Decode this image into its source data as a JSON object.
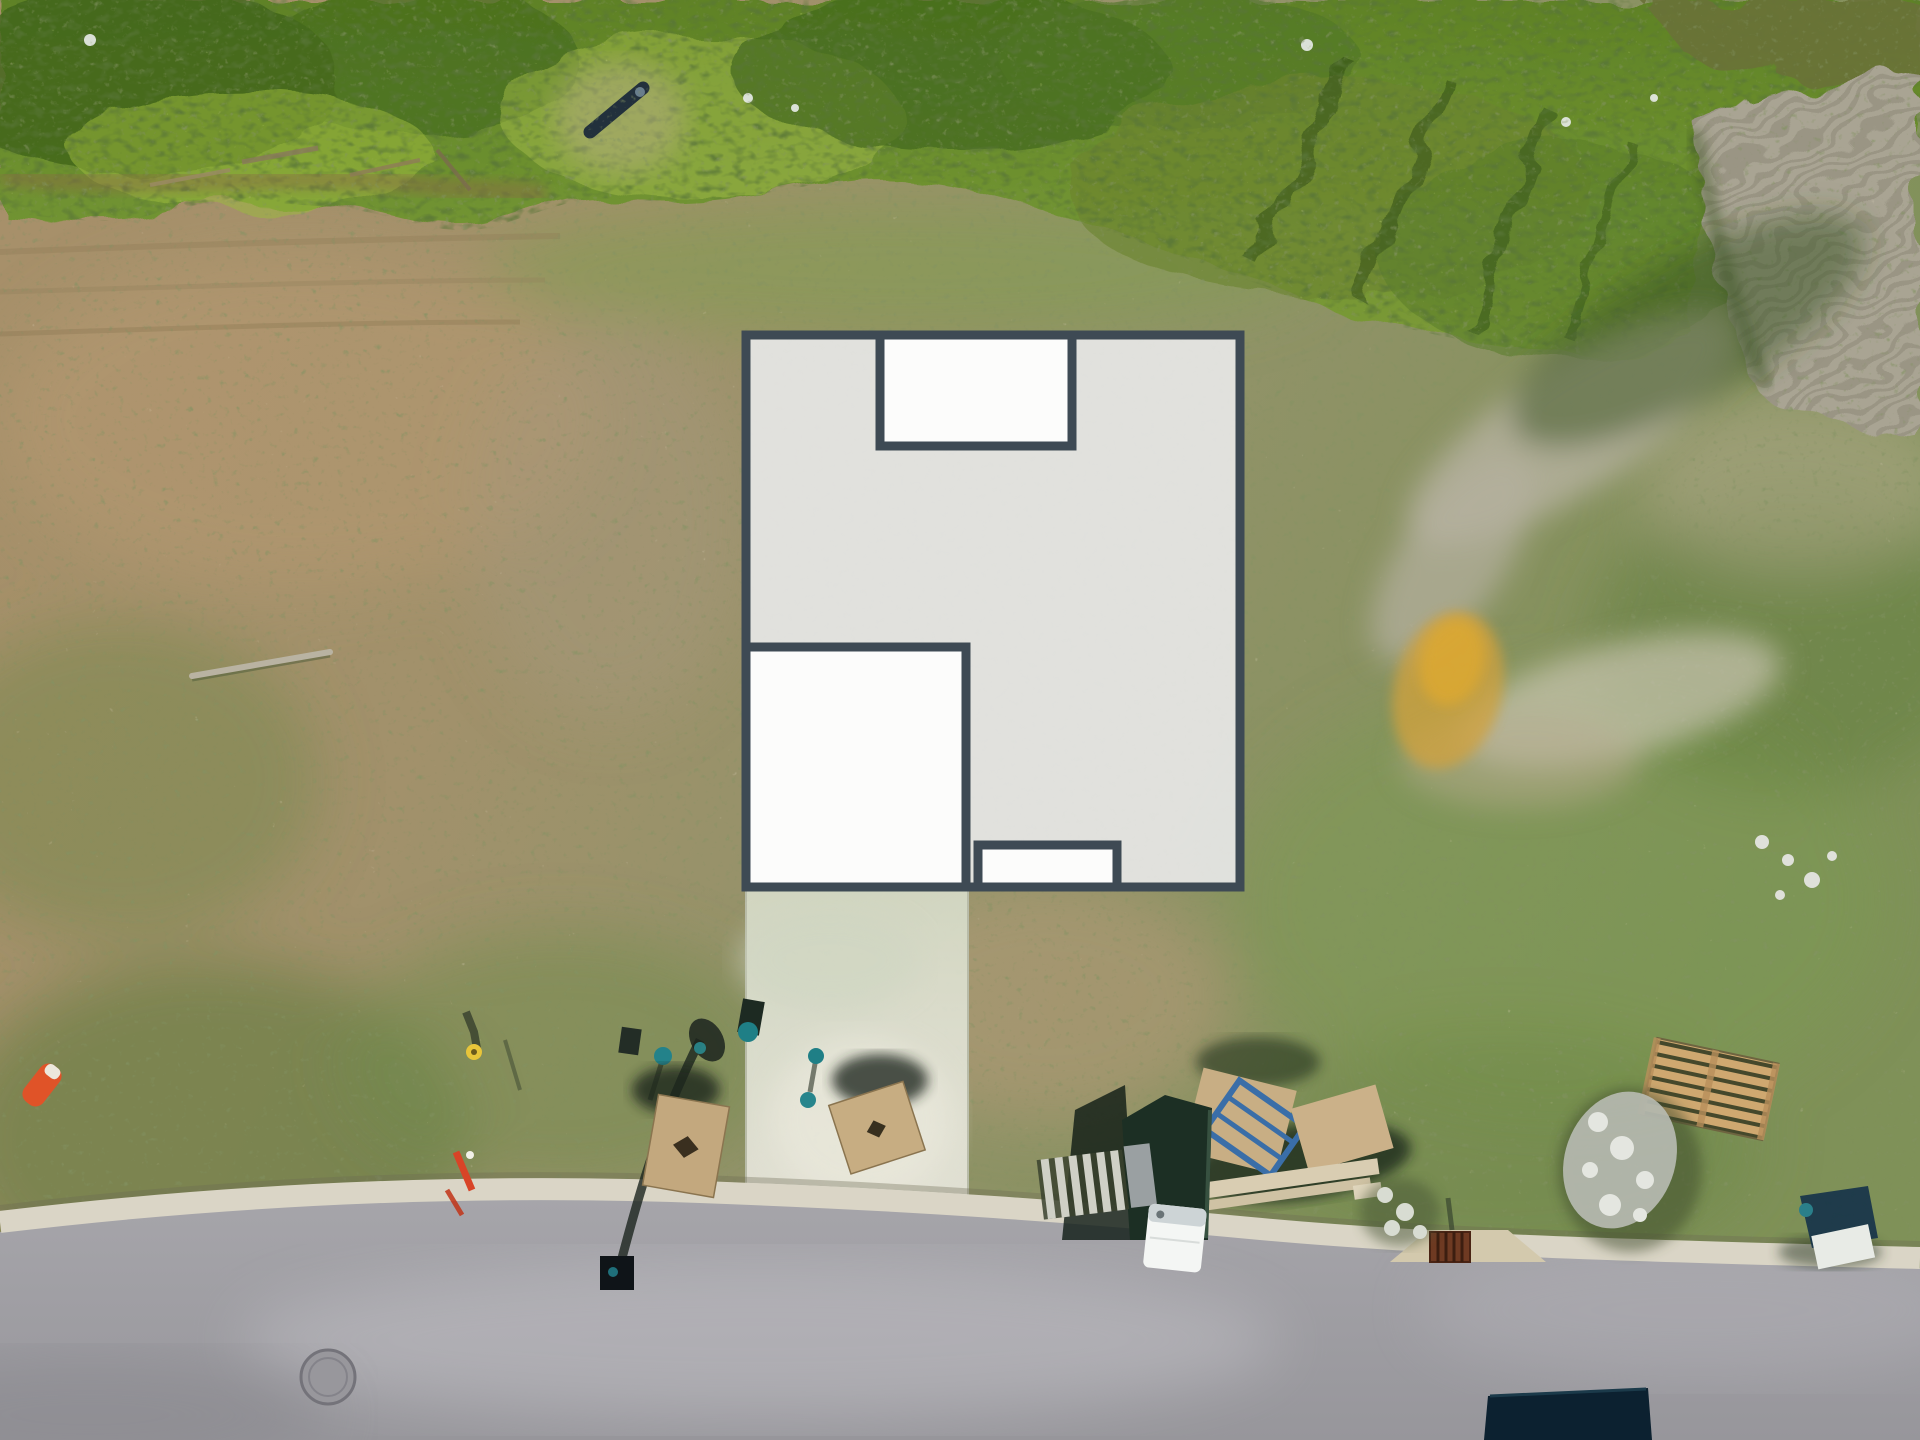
{
  "scene": {
    "title": "Aerial lot view with building footprint overlay",
    "description": "Top-down drone photograph of a cleared residential lot between a green tree line and a curbed street, with a gray proposed building footprint diagram overlaid on the ground and an existing light concrete driveway pad running from the footprint down to the road."
  },
  "palette": {
    "footprint_fill": "#e4e4e2",
    "footprint_room_fill": "#fdfdfc",
    "footprint_border": "#3e4a54",
    "driveway_concrete": "#dfe1d3",
    "curb_concrete": "#dad5c6",
    "road_asphalt": "#a2a1a6",
    "vegetation_green": "#6f9230",
    "field_dirt_tan": "#a8906a",
    "safety_cone_orange": "#e05328",
    "survey_cap_teal": "#23828a",
    "plywood_tan": "#c6ab80",
    "drain_rust": "#6e3a22",
    "dark_object_navy": "#0c2130"
  },
  "footprint": {
    "label": "Proposed building footprint overlay",
    "rooms": [
      {
        "name": "main-footprint",
        "label": "Main footprint area"
      },
      {
        "name": "top-room",
        "label": "Upper inset room / porch"
      },
      {
        "name": "left-room",
        "label": "Lower-left room / garage"
      },
      {
        "name": "bottom-stoop",
        "label": "Small bottom stoop"
      }
    ]
  },
  "objects": [
    {
      "name": "tree-line",
      "label": "Dense green vegetation band along top of lot"
    },
    {
      "name": "eroded-slope",
      "label": "Gray striated eroded slope at top right"
    },
    {
      "name": "dirt-field",
      "label": "Cleared dirt and patchy grass lot"
    },
    {
      "name": "driveway-pad",
      "label": "Light concrete driveway pad"
    },
    {
      "name": "street",
      "label": "Asphalt street with concrete curb"
    },
    {
      "name": "manhole-cover",
      "label": "Round manhole cover in street"
    },
    {
      "name": "storm-drain",
      "label": "Rust-colored storm drain grate at curb"
    },
    {
      "name": "safety-cone",
      "label": "Tipped orange safety cone"
    },
    {
      "name": "streetlight-shadow",
      "label": "Streetlight pole shadow and base box"
    },
    {
      "name": "survey-markers",
      "label": "Survey stakes with teal and yellow caps"
    },
    {
      "name": "plywood-boards",
      "label": "Plywood boards with cut holes"
    },
    {
      "name": "materials-pile",
      "label": "Plywood sheets, blue frame and lumber pile"
    },
    {
      "name": "portable-toilet",
      "label": "White portable toilet beside dark dumpster"
    },
    {
      "name": "wooden-pallet",
      "label": "Wooden pallet on grass"
    },
    {
      "name": "rubble-piles",
      "label": "White rock and debris piles"
    },
    {
      "name": "tarp-debris",
      "label": "Dark tarp and white sheet debris at curb"
    },
    {
      "name": "dark-object",
      "label": "Dark rectangular object at bottom edge of road"
    },
    {
      "name": "log",
      "label": "Thin fallen log on dirt"
    },
    {
      "name": "culvert-pipe",
      "label": "Dark pipe in upper vegetation"
    },
    {
      "name": "yellow-sand-patch",
      "label": "Ochre sandy patch on right side of lot"
    }
  ]
}
